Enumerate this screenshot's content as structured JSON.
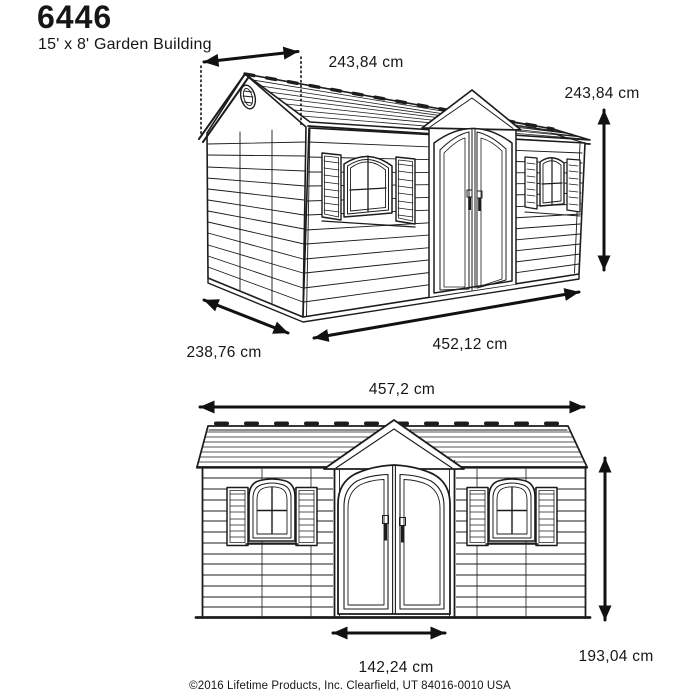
{
  "header": {
    "model": "6446",
    "subtitle": "15' x 8' Garden Building"
  },
  "perspective": {
    "dimensions": {
      "roof_width": "243,84 cm",
      "height": "243,84 cm",
      "depth": "238,76 cm",
      "length": "452,12 cm"
    }
  },
  "front": {
    "dimensions": {
      "width": "457,2 cm",
      "height": "193,04 cm",
      "door_width": "142,24 cm"
    }
  },
  "footer": {
    "copyright": "©2016 Lifetime Products, Inc. Clearfield, UT 84016-0010 USA"
  },
  "colors": {
    "line": "#1c1c1c",
    "dimension": "#111111",
    "background": "#ffffff"
  }
}
